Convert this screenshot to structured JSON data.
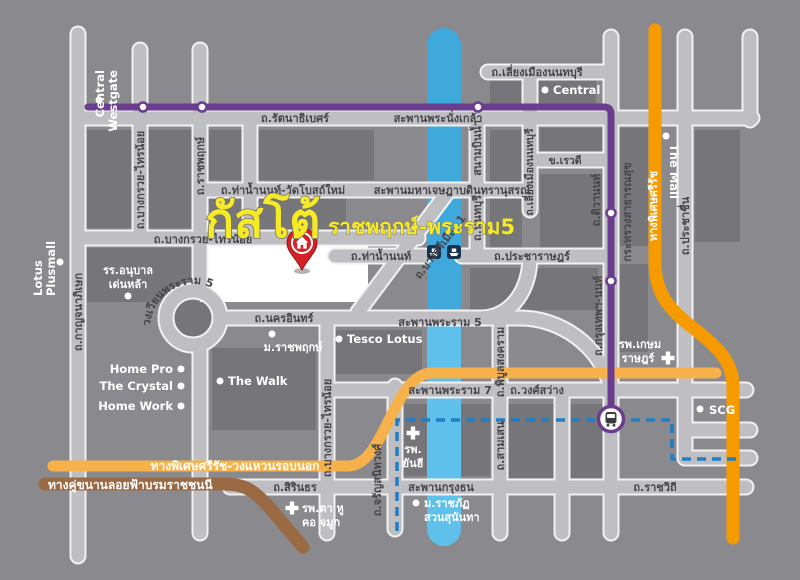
{
  "title": {
    "main": "กัสโต้",
    "sub": "ราชพฤกษ์-พระราม5"
  },
  "roads": {
    "rattanathibet": "ถ.รัตนาธิเบศร์",
    "phranangklao_bridge": "สะพานพระนั่งเกล้า",
    "liang_mueang_h": "ถ.เลี่ยงเมืองนนทบุรี",
    "thanam_non_watbot": "ถ.ท่าน้ำนนท์-วัดโบสถ์ใหม่",
    "jetsada_bridge": "สะพานมหาเจษฎาบดินทรานุสรณ์",
    "bangkruai_sainoi_h": "ถ.บางกรวย-ไทรน้อย",
    "thanam_non": "ถ.ท่าน้ำนนท์",
    "pracharat": "ถ.ประชาราษฎร์",
    "nakhon_in": "ถ.นครอินทร์",
    "rama5_bridge": "สะพานพระราม 5",
    "rama7_bridge": "สะพานพระราม 7",
    "wongsawang": "ถ.วงศ์สว่าง",
    "sirindhorn": "ถ.สิรินธร",
    "krungthon_bridge": "สะพานกรุงธน",
    "ratchawithi": "ถ.ราชวิถี",
    "rewadee": "ข.เรวดี",
    "kanchanaphisek": "ถ.กาญจนาภิเษก",
    "bangkruai_sainoi_v1": "ถ.บางกรวย-ไทรน้อย",
    "bangkruai_sainoi_v2": "ถ.บางกรวย-ไทรน้อย",
    "ratchaphruek": "ถ.ราชพฤกษ์",
    "charan": "ถ.จรัญสนิทวงศ์",
    "phibun": "ถ.พิบูลสงคราม",
    "samsen": "ถ.สามเสน",
    "sanambin_nam": "สนามบินน้ำ",
    "nonthaburi": "ถ.นนทบุรี",
    "liang_mueang_v": "ถ.เลี่ยงเมืองนนทบุรี",
    "tiwanon": "ถ.ติวานนท์",
    "krungthep_non": "ถ.กรุงเทพฯ-นนท์",
    "prachachuen": "ถ.ประชาชื่น",
    "bang_si_mueang": "ถ.บางศรีเมือง 1",
    "wongwian_rama5": "วงเวียนพระราม 5"
  },
  "routes": {
    "srirat": "ทางพิเศษศรีรัช",
    "srirat_outer": "ทางพิเศษศรีรัช-วงแหวนรอบนอก",
    "borom_parallel": "ทางคู่ขนานลอยฟ้าบรมราชชนนี"
  },
  "places": {
    "central_westgate_l1": "Central",
    "central_westgate_l2": "Westgate",
    "central": "Central",
    "lotus_l1": "Lotus",
    "lotus_l2": "Plusmall",
    "the_mall": "The Mall",
    "moph": "กระทรวงสาธารณสุข",
    "anuban_l1": "รร.อนุบาล",
    "anuban_l2": "เด่นหล้า",
    "m_ratchaphruek": "ม.ราชพฤกษ์",
    "tesco": "Tesco Lotus",
    "home_pro": "Home Pro",
    "the_crystal": "The Crystal",
    "home_work": "Home Work",
    "the_walk": "The Walk",
    "scg": "SCG",
    "yanhee_l1": "รพ.",
    "yanhee_l2": "ยันฮี",
    "kasemrad_l1": "รพ.เกษม",
    "kasemrad_l2": "ราษฎร์",
    "ta_hu_l1": "รพ.ตา หู",
    "ta_hu_l2": "คอ จมูก",
    "suan_sunandha_l1": "ม.ราชภัฏ",
    "suan_sunandha_l2": "สวนสุนันทา"
  },
  "icons": {
    "pin": "location-pin",
    "station": "mrt-station",
    "ferry": "ferry-crossing",
    "hospital": "hospital-cross"
  },
  "colors": {
    "background": "#8a8a8e",
    "block": "#76767a",
    "road": "#bfbfc3",
    "river_north": "#3fa9dc",
    "river_south": "#5fc0ec",
    "purple_line": "#6a3d8f",
    "orange_expressway": "#f59b00",
    "light_orange_expressway": "#f7b14a",
    "brown_road": "#9a6a45",
    "dashed_blue": "#1f7fc4",
    "highlight_yellow": "#f6e926",
    "pin_red": "#d42127"
  }
}
